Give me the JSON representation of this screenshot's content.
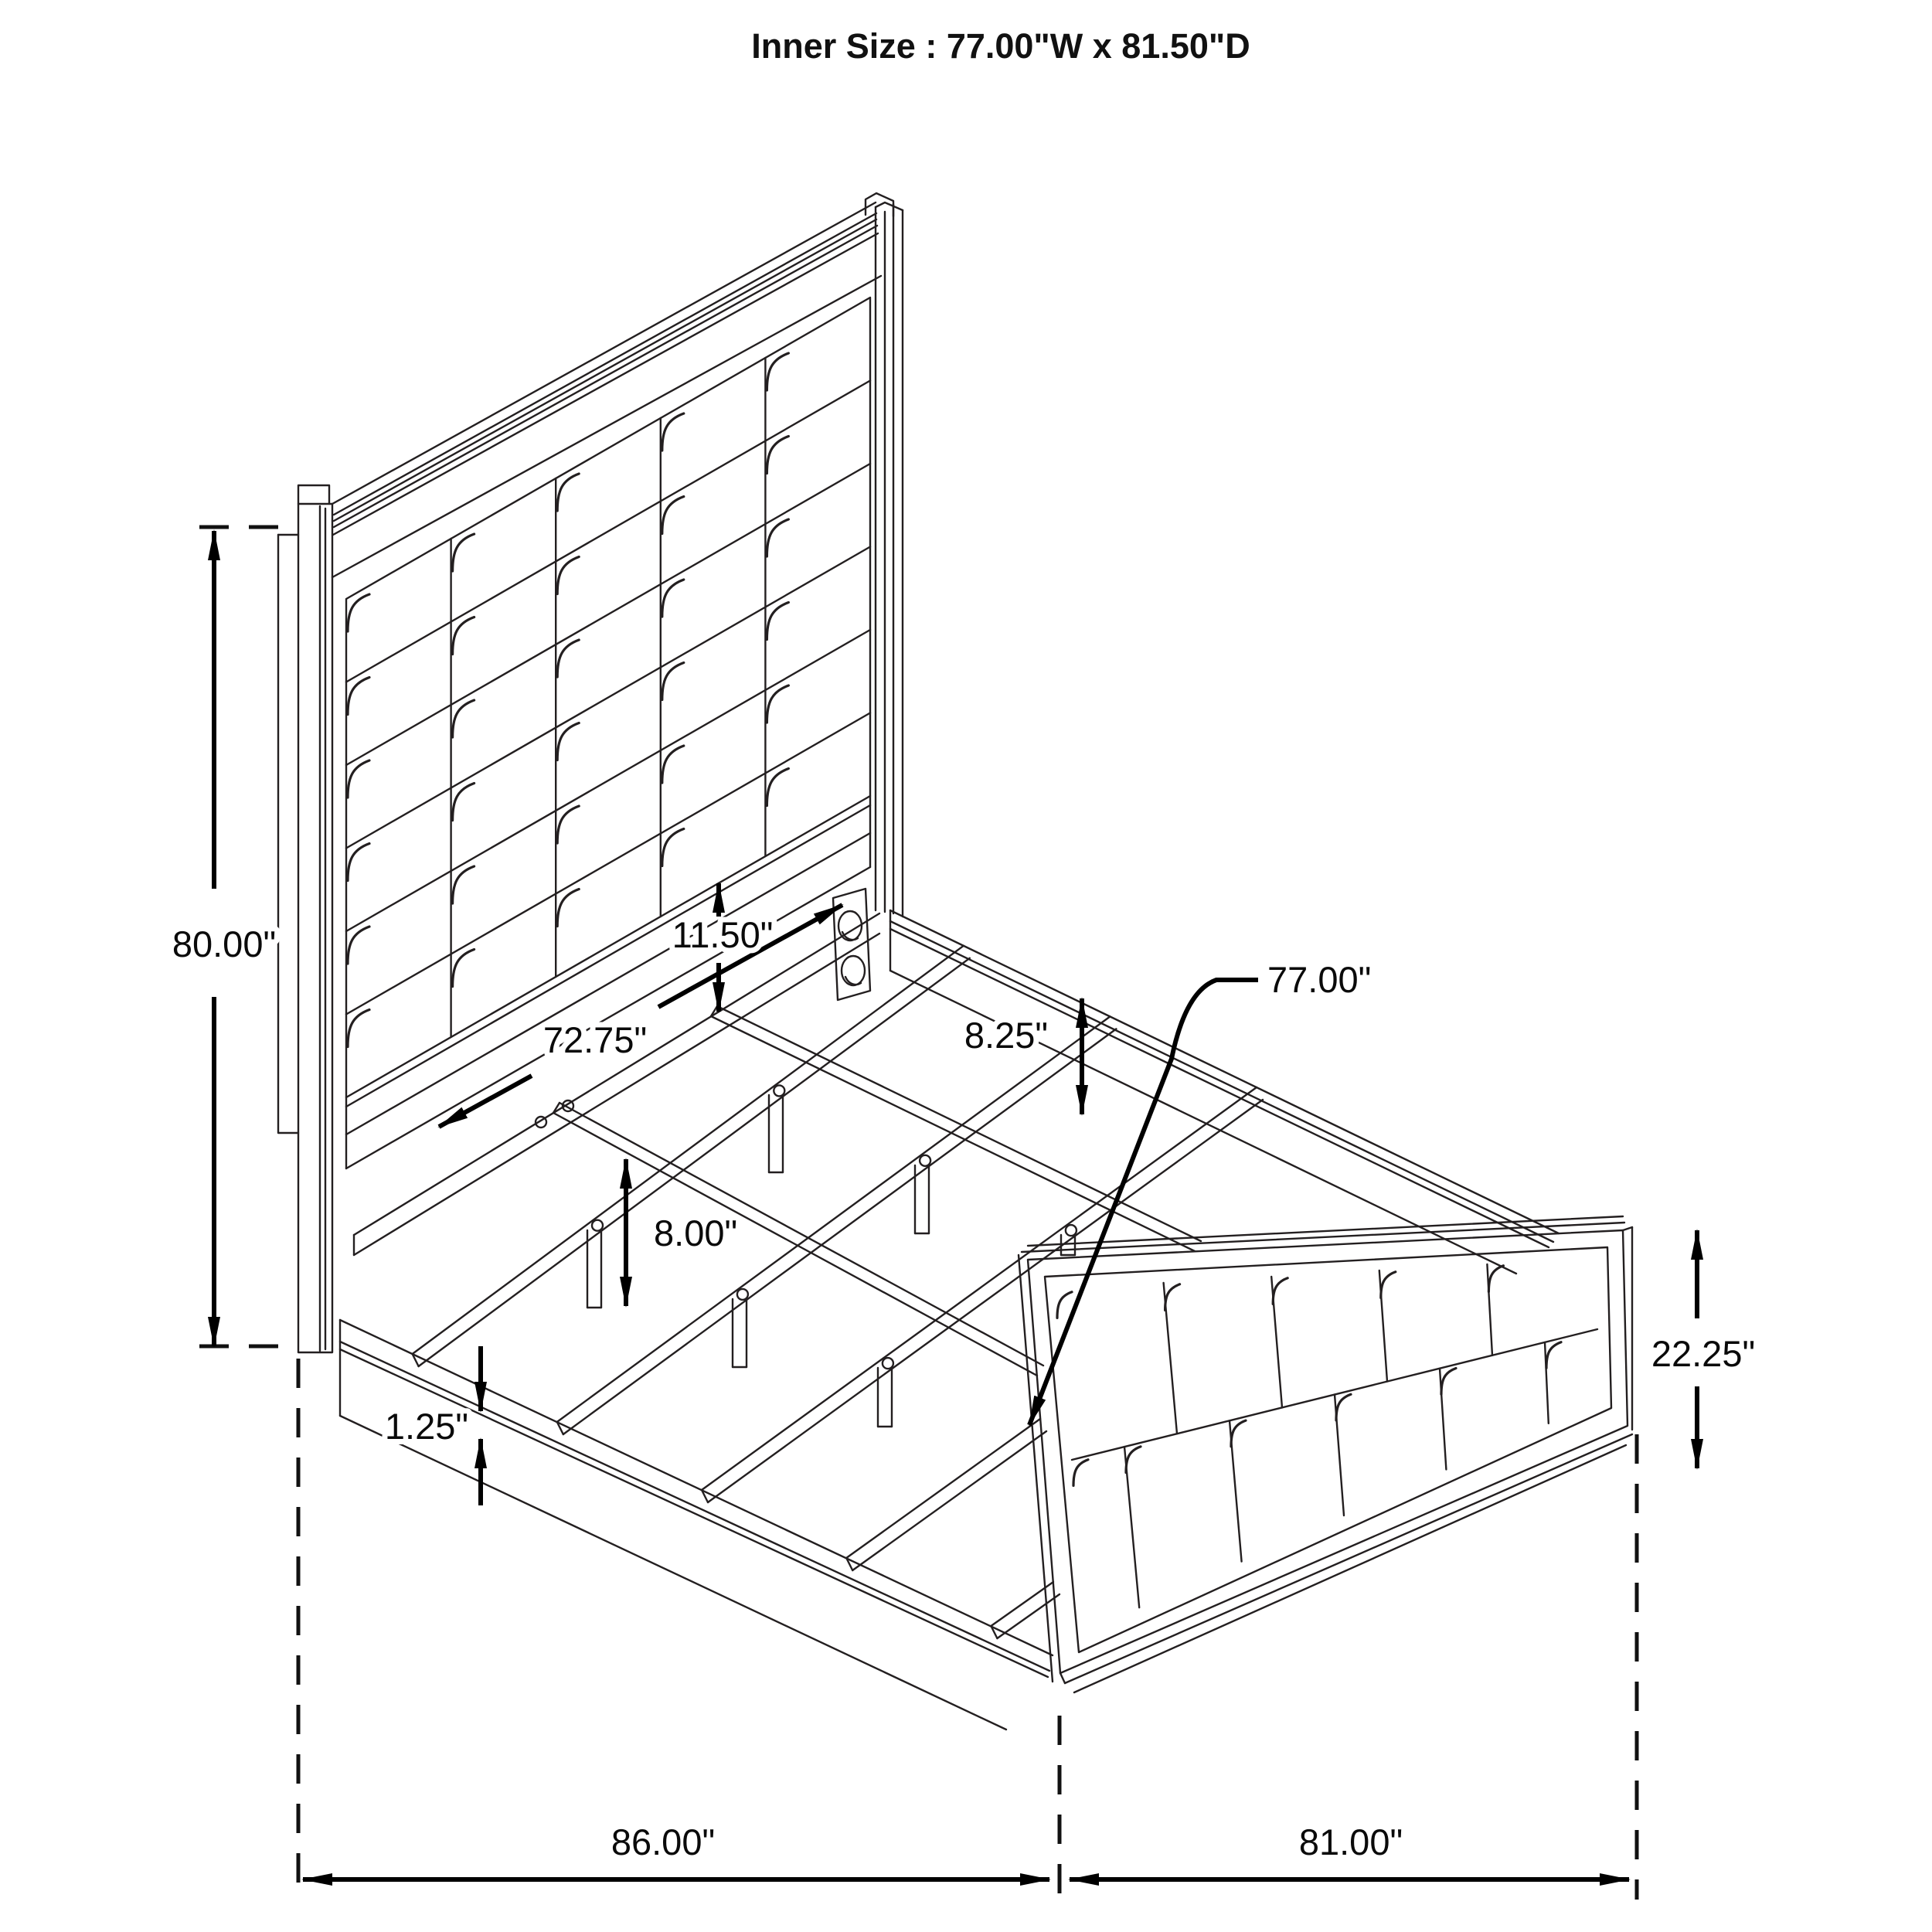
{
  "title": "Inner Size : 77.00\"W x 81.50\"D",
  "dimensions": {
    "headboard_height": {
      "label": "80.00\""
    },
    "panel_to_rail_gap": {
      "label": "11.50\""
    },
    "cleat_rail_length": {
      "label": "72.75\""
    },
    "side_rail_height": {
      "label": "8.25\""
    },
    "slat_length": {
      "label": "77.00\""
    },
    "support_leg_height": {
      "label": "8.00\""
    },
    "rail_lip_thickness": {
      "label": "1.25\""
    },
    "footboard_height": {
      "label": "22.25\""
    },
    "overall_width": {
      "label": "86.00\""
    },
    "overall_depth": {
      "label": "81.00\""
    }
  },
  "drawing": {
    "line_color": "#231f20",
    "dimension_color": "#000000",
    "background": "#ffffff"
  }
}
